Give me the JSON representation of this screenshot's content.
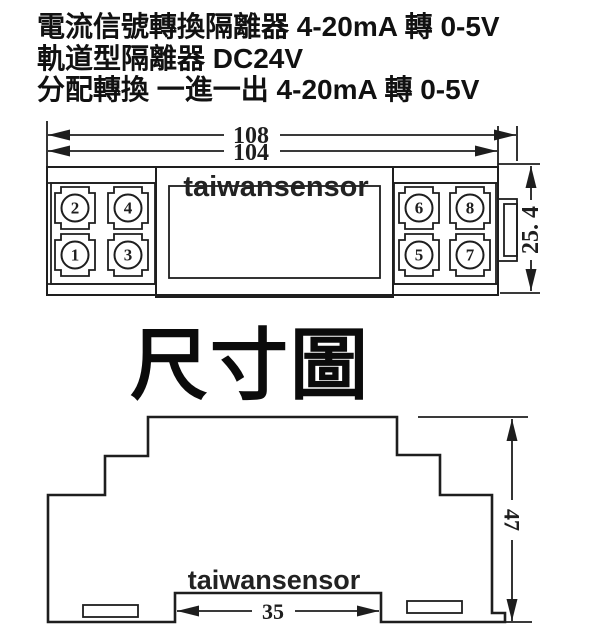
{
  "header": {
    "line1": "電流信號轉換隔離器 4-20mA 轉 0-5V",
    "line2": "軌道型隔離器 DC24V",
    "line3": "分配轉換 一進一出 4-20mA 轉 0-5V"
  },
  "section_title": "尺寸圖",
  "watermark": "taiwansensor",
  "colors": {
    "ink": "#1e1e1e",
    "background": "#ffffff"
  },
  "top_view": {
    "dim_width_outer": "108",
    "dim_width_body": "104",
    "dim_height": "25. 4",
    "terminals_left": [
      "2",
      "4",
      "1",
      "3"
    ],
    "terminals_right": [
      "6",
      "8",
      "5",
      "7"
    ]
  },
  "side_view": {
    "dim_height": "47",
    "dim_rail_width": "35"
  }
}
